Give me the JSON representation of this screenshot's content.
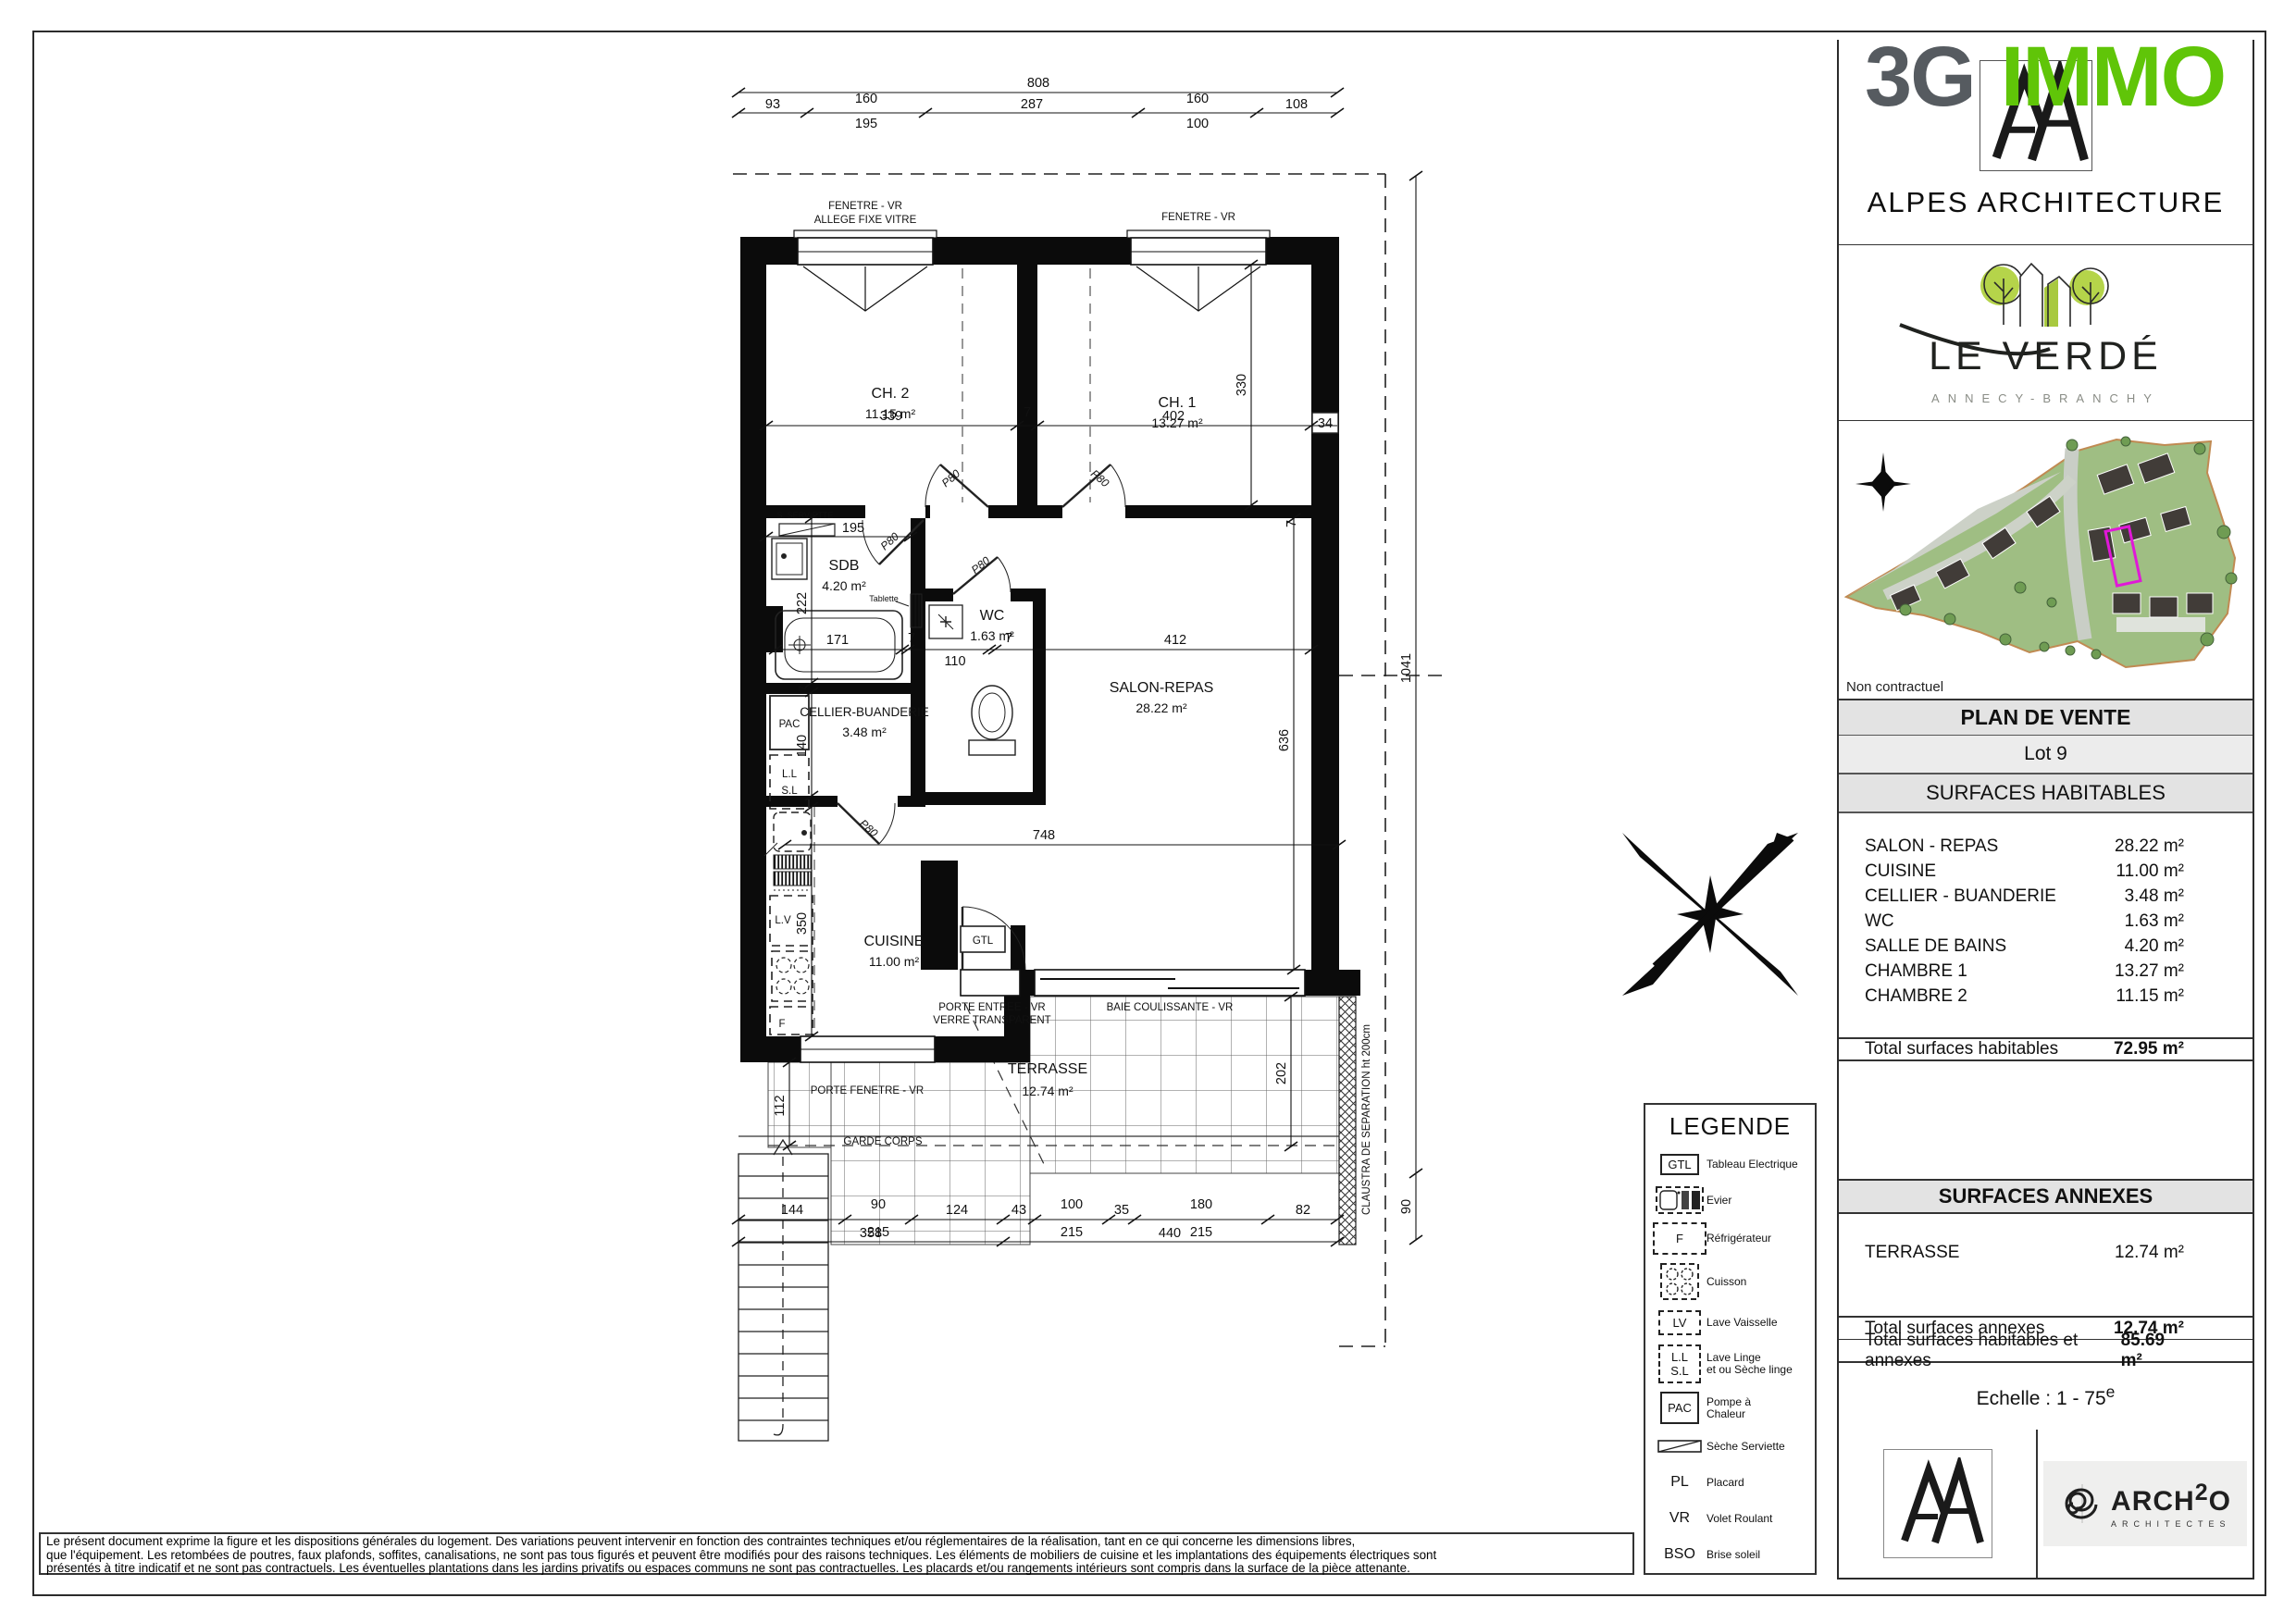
{
  "branding": {
    "logo_3g": "3G",
    "logo_immo": "IMMO",
    "alpes": "ALPES ARCHITECTURE",
    "le_verde": "LE VERDÉ",
    "le_verde_sub": "ANNECY-BRANCHY",
    "non_contractuel": "Non contractuel",
    "arch2o_pre": "ARCH",
    "arch2o_sup": "2",
    "arch2o_post": "O",
    "arch2o_sub": "ARCHITECTES",
    "accent_green": "#60c508",
    "accent_gray": "#565b60"
  },
  "panel": {
    "plan_de_vente": "PLAN DE VENTE",
    "lot": "Lot 9",
    "surfaces_habitables": {
      "title": "SURFACES HABITABLES",
      "rows": [
        {
          "label": "SALON - REPAS",
          "value": "28.22 m²"
        },
        {
          "label": "CUISINE",
          "value": "11.00 m²"
        },
        {
          "label": "CELLIER - BUANDERIE",
          "value": "3.48 m²"
        },
        {
          "label": "WC",
          "value": "1.63 m²"
        },
        {
          "label": "SALLE DE BAINS",
          "value": "4.20 m²"
        },
        {
          "label": "CHAMBRE 1",
          "value": "13.27 m²"
        },
        {
          "label": "CHAMBRE 2",
          "value": "11.15 m²"
        }
      ],
      "total_label": "Total surfaces habitables",
      "total_value": "72.95 m²"
    },
    "surfaces_annexes": {
      "title": "SURFACES ANNEXES",
      "rows": [
        {
          "label": "TERRASSE",
          "value": "12.74 m²"
        }
      ],
      "total_label": "Total surfaces annexes",
      "total_value": "12.74 m²",
      "grand_total_label": "Total surfaces habitables et annexes",
      "grand_total_value": "85.69 m²"
    },
    "echelle": "Echelle : 1 - 75",
    "echelle_sup": "e"
  },
  "legend": {
    "title": "LEGENDE",
    "items": [
      {
        "symbol": "GTL",
        "label": "Tableau Electrique"
      },
      {
        "symbol": "",
        "label": "Evier"
      },
      {
        "symbol": "F",
        "label": "Réfrigérateur"
      },
      {
        "symbol": "",
        "label": "Cuisson"
      },
      {
        "symbol": "LV",
        "label": "Lave Vaisselle"
      },
      {
        "symbol": "L.L",
        "symbol2": "S.L",
        "label": "Lave Linge",
        "label2": "et ou Sèche linge"
      },
      {
        "symbol": "PAC",
        "label": "Pompe à",
        "label2": "Chaleur"
      },
      {
        "symbol": "",
        "label": "Sèche Serviette"
      },
      {
        "symbol": "PL",
        "label": "Placard"
      },
      {
        "symbol": "VR",
        "label": "Volet Roulant"
      },
      {
        "symbol": "BSO",
        "label": "Brise soleil"
      }
    ]
  },
  "disclaimer": {
    "line1": "Le présent document exprime la figure et les dispositions générales du logement. Des variations peuvent intervenir en fonction des contraintes techniques et/ou réglementaires de la réalisation, tant en ce qui concerne les dimensions libres,",
    "line2": "que l'équipement. Les retombées de poutres, faux plafonds, soffites, canalisations, ne sont pas tous figurés et peuvent être modifiés pour des raisons techniques. Les éléments de mobiliers de cuisine et les implantations des équipements électriques sont",
    "line3": "présentés à titre indicatif et ne sont pas contractuels. Les éventuelles plantations dans les jardins privatifs ou espaces communs ne sont pas contractuelles. Les placards et/ou rangements intérieurs sont compris dans la surface de la pièce attenante."
  },
  "plan": {
    "labels": {
      "fenetre_vr": "FENETRE - VR",
      "allege": "ALLEGE FIXE VITRE",
      "ch2": "CH. 2",
      "ch2_area": "11.15 m²",
      "ch1": "CH. 1",
      "ch1_area": "13.27 m²",
      "sdb": "SDB",
      "sdb_area": "4.20 m²",
      "wc": "WC",
      "wc_area": "1.63 m²",
      "salon": "SALON-REPAS",
      "salon_area": "28.22 m²",
      "cellier": "CELLIER-BUANDERIE",
      "cellier_area": "3.48 m²",
      "cuisine": "CUISINE",
      "cuisine_area": "11.00 m²",
      "terrasse": "TERRASSE",
      "terrasse_area": "12.74 m²",
      "porte_fenetre": "PORTE FENETRE - VR",
      "porte_entree": "PORTE ENTREE - VR",
      "verre": "VERRE TRANSPARENT",
      "baie": "BAIE COULISSANTE - VR",
      "garde_corps": "GARDE CORPS",
      "claustra": "CLAUSTRA DE SEPARATION ht 200cm",
      "s_serviette": "S. SERVIETTE",
      "tablette": "Tablette",
      "gtl": "GTL",
      "pac": "PAC",
      "ll": "L.L",
      "sl": "S.L",
      "lv": "L.V",
      "f": "F",
      "p80": "P80"
    },
    "dims": {
      "d808": "808",
      "d93": "93",
      "d160": "160",
      "d287": "287",
      "d108": "108",
      "d195t": "195",
      "d100": "100",
      "d339": "339",
      "d7": "7",
      "d402": "402",
      "d34": "34",
      "d330": "330",
      "d195": "195",
      "d222": "222",
      "d171": "171",
      "d110": "110",
      "d412": "412",
      "d636": "636",
      "d140": "140",
      "d350": "350",
      "d748": "748",
      "d112": "112",
      "d202": "202",
      "d1041": "1041",
      "d90": "90",
      "d144": "144",
      "d215": "215",
      "d124": "124",
      "d43": "43",
      "d35": "35",
      "d180": "180",
      "d82": "82",
      "d358": "358",
      "d440": "440"
    }
  }
}
